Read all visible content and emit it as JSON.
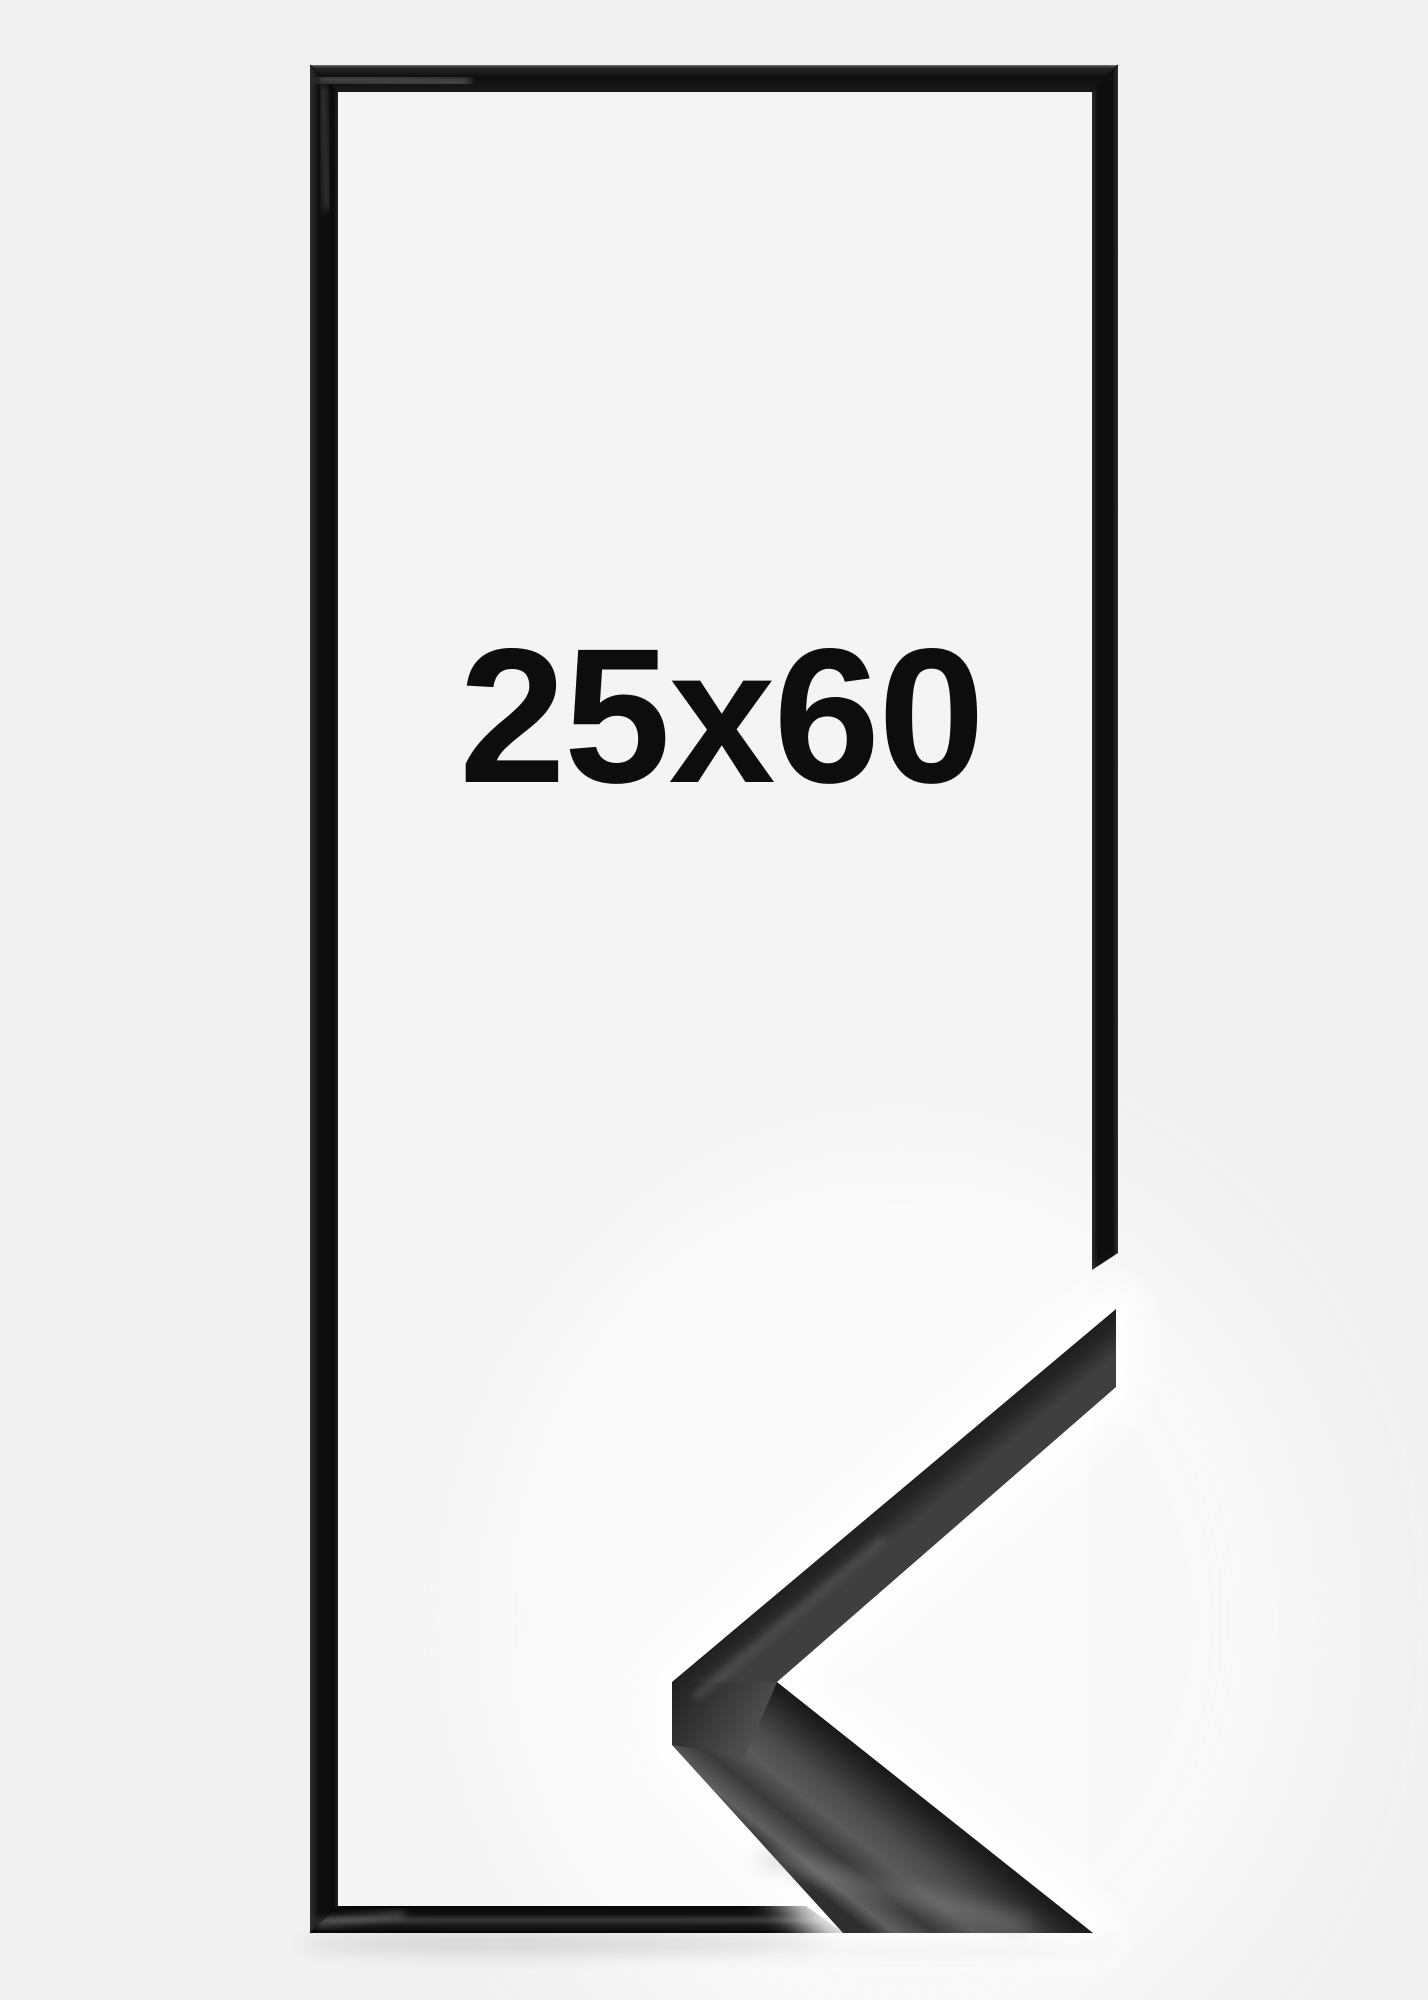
{
  "image": {
    "size_label": "25x60",
    "colors": {
      "background": "#f1f1f1",
      "frame_interior": "#f4f4f4",
      "frame_black": "#131313",
      "sample_dark": "#1b1b1b",
      "sample_gray": "#555555",
      "glow_white": "#ffffff",
      "text": "#0d0d0d"
    }
  }
}
